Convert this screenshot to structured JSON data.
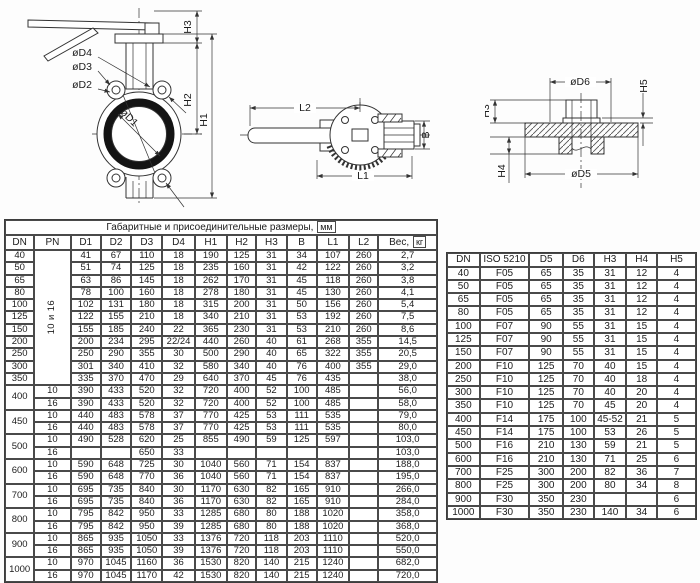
{
  "drawings": {
    "front_view": {
      "d4": "øD4",
      "d3": "øD3",
      "d2": "øD2",
      "d1": "øD1",
      "h3": "H3",
      "h2": "H2",
      "h1": "H1"
    },
    "top_view": {
      "l2": "L2",
      "l1": "L1",
      "b": "B"
    },
    "flange_view": {
      "d6": "øD6",
      "h5": "H5",
      "h3": "H3",
      "h4": "H4",
      "d5": "øD5"
    }
  },
  "main_table": {
    "title": "Габаритные и присоединительные размеры,",
    "title_unit": "мм",
    "columns": [
      "DN",
      "PN",
      "D1",
      "D2",
      "D3",
      "D4",
      "H1",
      "H2",
      "H3",
      "B",
      "L1",
      "L2"
    ],
    "weight_label": "Вес,",
    "weight_unit": "кг",
    "rows": [
      [
        "40",
        {
          "text": "10 и 16",
          "rowspan": 11,
          "rotate": true
        },
        "41",
        "67",
        "110",
        "18",
        "190",
        "125",
        "31",
        "34",
        "107",
        "260",
        "2,7"
      ],
      [
        "50",
        null,
        "51",
        "74",
        "125",
        "18",
        "235",
        "160",
        "31",
        "42",
        "122",
        "260",
        "3,2"
      ],
      [
        "65",
        null,
        "63",
        "86",
        "145",
        "18",
        "262",
        "170",
        "31",
        "45",
        "118",
        "260",
        "3,8"
      ],
      [
        "80",
        null,
        "78",
        "100",
        "160",
        "18",
        "278",
        "180",
        "31",
        "45",
        "130",
        "260",
        "4,1"
      ],
      [
        "100",
        null,
        "102",
        "131",
        "180",
        "18",
        "315",
        "200",
        "31",
        "50",
        "156",
        "260",
        "5,4"
      ],
      [
        "125",
        null,
        "122",
        "155",
        "210",
        "18",
        "340",
        "210",
        "31",
        "53",
        "192",
        "260",
        "7,5"
      ],
      [
        "150",
        null,
        "155",
        "185",
        "240",
        "22",
        "365",
        "230",
        "31",
        "53",
        "210",
        "260",
        "8,6"
      ],
      [
        "200",
        null,
        "200",
        "234",
        "295",
        "22/24",
        "440",
        "260",
        "40",
        "61",
        "268",
        "355",
        "14,5"
      ],
      [
        "250",
        null,
        "250",
        "290",
        "355",
        "30",
        "500",
        "290",
        "40",
        "65",
        "322",
        "355",
        "20,5"
      ],
      [
        "300",
        null,
        "301",
        "340",
        "410",
        "32",
        "580",
        "340",
        "40",
        "76",
        "400",
        "355",
        "29,0"
      ],
      [
        "350",
        null,
        "335",
        "370",
        "470",
        "29",
        "640",
        "370",
        "45",
        "76",
        "435",
        "",
        "38,0"
      ],
      [
        {
          "text": "400",
          "rowspan": 2
        },
        "10",
        "390",
        "433",
        "520",
        "32",
        "720",
        "400",
        "52",
        "100",
        "485",
        "",
        "56,0"
      ],
      [
        null,
        "16",
        "390",
        "433",
        "520",
        "32",
        "720",
        "400",
        "52",
        "100",
        "485",
        "",
        "58,0"
      ],
      [
        {
          "text": "450",
          "rowspan": 2
        },
        "10",
        "440",
        "483",
        "578",
        "37",
        "770",
        "425",
        "53",
        "111",
        "535",
        "",
        "79,0"
      ],
      [
        null,
        "16",
        "440",
        "483",
        "578",
        "37",
        "770",
        "425",
        "53",
        "111",
        "535",
        "",
        "80,0"
      ],
      [
        {
          "text": "500",
          "rowspan": 2
        },
        "10",
        "490",
        "528",
        "620",
        "25",
        "855",
        "490",
        "59",
        "125",
        "597",
        "",
        "103,0"
      ],
      [
        null,
        "16",
        "",
        "",
        "650",
        "33",
        "",
        "",
        "",
        "",
        "",
        "",
        "103,0"
      ],
      [
        {
          "text": "600",
          "rowspan": 2
        },
        "10",
        "590",
        "648",
        "725",
        "30",
        "1040",
        "560",
        "71",
        "154",
        "837",
        "",
        "188,0"
      ],
      [
        null,
        "16",
        "590",
        "648",
        "770",
        "36",
        "1040",
        "560",
        "71",
        "154",
        "837",
        "",
        "195,0"
      ],
      [
        {
          "text": "700",
          "rowspan": 2
        },
        "10",
        "695",
        "735",
        "840",
        "30",
        "1170",
        "630",
        "82",
        "165",
        "910",
        "",
        "266,0"
      ],
      [
        null,
        "16",
        "695",
        "735",
        "840",
        "36",
        "1170",
        "630",
        "82",
        "165",
        "910",
        "",
        "284,0"
      ],
      [
        {
          "text": "800",
          "rowspan": 2
        },
        "10",
        "795",
        "842",
        "950",
        "33",
        "1285",
        "680",
        "80",
        "188",
        "1020",
        "",
        "358,0"
      ],
      [
        null,
        "16",
        "795",
        "842",
        "950",
        "39",
        "1285",
        "680",
        "80",
        "188",
        "1020",
        "",
        "368,0"
      ],
      [
        {
          "text": "900",
          "rowspan": 2
        },
        "10",
        "865",
        "935",
        "1050",
        "33",
        "1376",
        "720",
        "118",
        "203",
        "1110",
        "",
        "520,0"
      ],
      [
        null,
        "16",
        "865",
        "935",
        "1050",
        "39",
        "1376",
        "720",
        "118",
        "203",
        "1110",
        "",
        "550,0"
      ],
      [
        {
          "text": "1000",
          "rowspan": 2
        },
        "10",
        "970",
        "1045",
        "1160",
        "36",
        "1530",
        "820",
        "140",
        "215",
        "1240",
        "",
        "682,0"
      ],
      [
        null,
        "16",
        "970",
        "1045",
        "1170",
        "42",
        "1530",
        "820",
        "140",
        "215",
        "1240",
        "",
        "720,0"
      ]
    ]
  },
  "iso_table": {
    "columns": [
      "DN",
      "ISO 5210",
      "D5",
      "D6",
      "H3",
      "H4",
      "H5"
    ],
    "rows": [
      [
        "40",
        "F05",
        "65",
        "35",
        "31",
        "12",
        "4"
      ],
      [
        "50",
        "F05",
        "65",
        "35",
        "31",
        "12",
        "4"
      ],
      [
        "65",
        "F05",
        "65",
        "35",
        "31",
        "12",
        "4"
      ],
      [
        "80",
        "F05",
        "65",
        "35",
        "31",
        "12",
        "4"
      ],
      [
        "100",
        "F07",
        "90",
        "55",
        "31",
        "15",
        "4"
      ],
      [
        "125",
        "F07",
        "90",
        "55",
        "31",
        "15",
        "4"
      ],
      [
        "150",
        "F07",
        "90",
        "55",
        "31",
        "15",
        "4"
      ],
      [
        "200",
        "F10",
        "125",
        "70",
        "40",
        "15",
        "4"
      ],
      [
        "250",
        "F10",
        "125",
        "70",
        "40",
        "18",
        "4"
      ],
      [
        "300",
        "F10",
        "125",
        "70",
        "40",
        "20",
        "4"
      ],
      [
        "350",
        "F10",
        "125",
        "70",
        "45",
        "20",
        "4"
      ],
      [
        "400",
        "F14",
        "175",
        "100",
        "45-52",
        "21",
        "5"
      ],
      [
        "450",
        "F14",
        "175",
        "100",
        "53",
        "26",
        "5"
      ],
      [
        "500",
        "F16",
        "210",
        "130",
        "59",
        "21",
        "5"
      ],
      [
        "600",
        "F16",
        "210",
        "130",
        "71",
        "25",
        "6"
      ],
      [
        "700",
        "F25",
        "300",
        "200",
        "82",
        "36",
        "7"
      ],
      [
        "800",
        "F25",
        "300",
        "200",
        "80",
        "34",
        "8"
      ],
      [
        "900",
        "F30",
        "350",
        "230",
        "",
        "",
        "6"
      ],
      [
        "1000",
        "F30",
        "350",
        "230",
        "140",
        "34",
        "6"
      ]
    ]
  }
}
